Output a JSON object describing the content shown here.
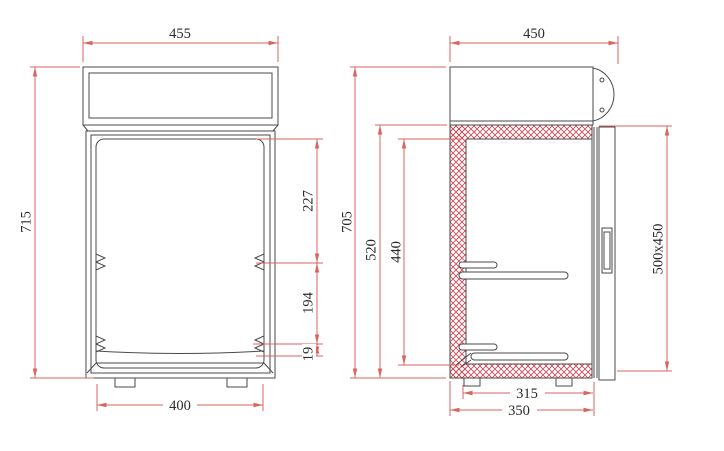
{
  "colors": {
    "outline": "#4a4a4a",
    "dimension_line": "#d9655f",
    "insulation_hatch": "#ce4a55",
    "background": "#ffffff"
  },
  "front_view": {
    "top_width": "455",
    "overall_height": "715",
    "door_top_to_first_shelf": "227",
    "first_to_second_shelf": "194",
    "second_shelf_to_base": "19",
    "base_width": "400"
  },
  "side_view": {
    "top_depth": "450",
    "overall_height": "705",
    "cavity_height_outer": "520",
    "cavity_height_inner": "440",
    "door_dimensions": "500x450",
    "inner_base_depth": "315",
    "base_depth": "350"
  }
}
